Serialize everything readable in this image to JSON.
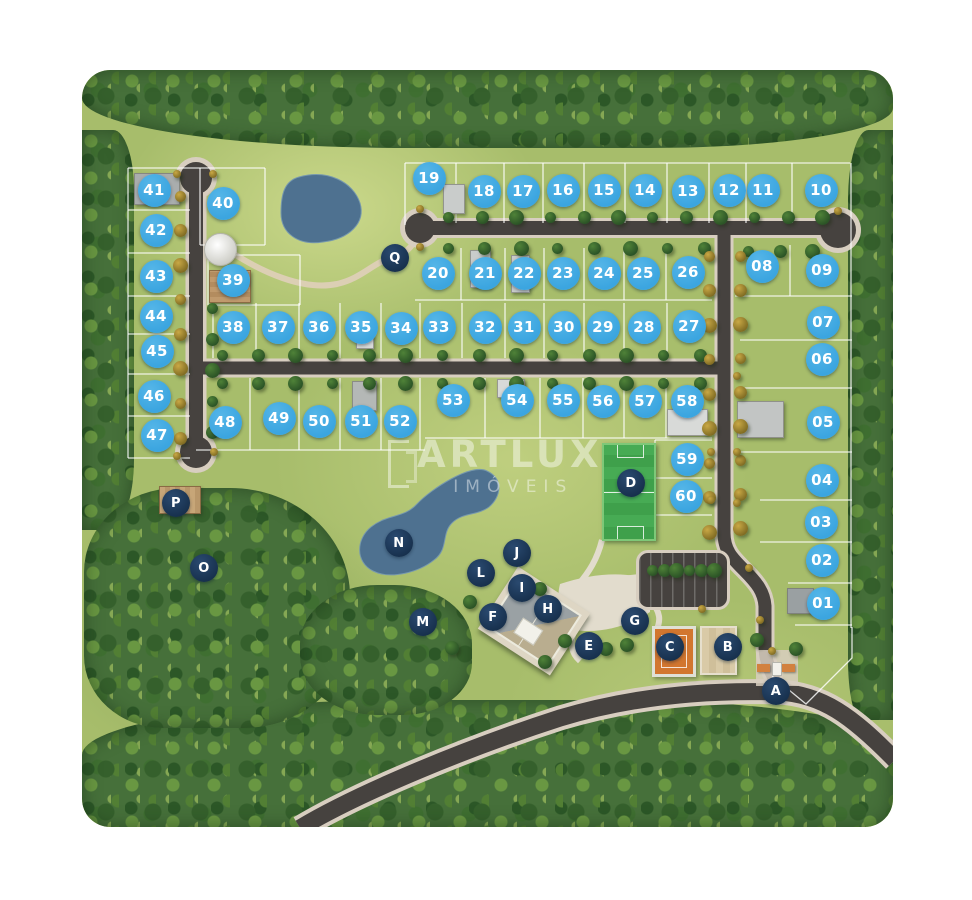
{
  "map": {
    "watermark": {
      "title": "ARTLUX",
      "subtitle": "IMÓVEIS"
    },
    "colors": {
      "lot_marker": "#3BA5E0",
      "amenity_marker": "#17304D",
      "marker_text": "#FFFFFF",
      "road": "#46423F",
      "road_edge": "#D8CEC0",
      "grass": "#A7BD6B",
      "forest": "#46703A",
      "lake": "#4E7190",
      "soccer_field": "#3FA04B",
      "tennis_court": "#D2762F",
      "sand_court": "#D9CAA7"
    },
    "lots": [
      {
        "label": "01",
        "x": 823,
        "y": 603
      },
      {
        "label": "02",
        "x": 822,
        "y": 560
      },
      {
        "label": "03",
        "x": 821,
        "y": 522
      },
      {
        "label": "04",
        "x": 822,
        "y": 480
      },
      {
        "label": "05",
        "x": 823,
        "y": 422
      },
      {
        "label": "06",
        "x": 822,
        "y": 359
      },
      {
        "label": "07",
        "x": 823,
        "y": 322
      },
      {
        "label": "08",
        "x": 762,
        "y": 266
      },
      {
        "label": "09",
        "x": 822,
        "y": 270
      },
      {
        "label": "10",
        "x": 821,
        "y": 190
      },
      {
        "label": "11",
        "x": 763,
        "y": 190
      },
      {
        "label": "12",
        "x": 729,
        "y": 190
      },
      {
        "label": "13",
        "x": 688,
        "y": 191
      },
      {
        "label": "14",
        "x": 645,
        "y": 190
      },
      {
        "label": "15",
        "x": 604,
        "y": 190
      },
      {
        "label": "16",
        "x": 563,
        "y": 190
      },
      {
        "label": "17",
        "x": 523,
        "y": 191
      },
      {
        "label": "18",
        "x": 484,
        "y": 191
      },
      {
        "label": "19",
        "x": 429,
        "y": 178
      },
      {
        "label": "20",
        "x": 438,
        "y": 273
      },
      {
        "label": "21",
        "x": 485,
        "y": 273
      },
      {
        "label": "22",
        "x": 524,
        "y": 273
      },
      {
        "label": "23",
        "x": 563,
        "y": 273
      },
      {
        "label": "24",
        "x": 604,
        "y": 273
      },
      {
        "label": "25",
        "x": 643,
        "y": 273
      },
      {
        "label": "26",
        "x": 688,
        "y": 272
      },
      {
        "label": "27",
        "x": 689,
        "y": 326
      },
      {
        "label": "28",
        "x": 644,
        "y": 327
      },
      {
        "label": "29",
        "x": 603,
        "y": 327
      },
      {
        "label": "30",
        "x": 564,
        "y": 327
      },
      {
        "label": "31",
        "x": 524,
        "y": 327
      },
      {
        "label": "32",
        "x": 485,
        "y": 327
      },
      {
        "label": "33",
        "x": 439,
        "y": 327
      },
      {
        "label": "34",
        "x": 401,
        "y": 328
      },
      {
        "label": "35",
        "x": 361,
        "y": 327
      },
      {
        "label": "36",
        "x": 319,
        "y": 327
      },
      {
        "label": "37",
        "x": 278,
        "y": 327
      },
      {
        "label": "38",
        "x": 233,
        "y": 327
      },
      {
        "label": "39",
        "x": 233,
        "y": 280
      },
      {
        "label": "40",
        "x": 223,
        "y": 203
      },
      {
        "label": "41",
        "x": 154,
        "y": 190
      },
      {
        "label": "42",
        "x": 156,
        "y": 230
      },
      {
        "label": "43",
        "x": 156,
        "y": 276
      },
      {
        "label": "44",
        "x": 156,
        "y": 316
      },
      {
        "label": "45",
        "x": 157,
        "y": 351
      },
      {
        "label": "46",
        "x": 154,
        "y": 396
      },
      {
        "label": "47",
        "x": 157,
        "y": 435
      },
      {
        "label": "48",
        "x": 225,
        "y": 422
      },
      {
        "label": "49",
        "x": 279,
        "y": 418
      },
      {
        "label": "50",
        "x": 319,
        "y": 421
      },
      {
        "label": "51",
        "x": 361,
        "y": 421
      },
      {
        "label": "52",
        "x": 400,
        "y": 421
      },
      {
        "label": "53",
        "x": 453,
        "y": 400
      },
      {
        "label": "54",
        "x": 517,
        "y": 400
      },
      {
        "label": "55",
        "x": 563,
        "y": 400
      },
      {
        "label": "56",
        "x": 603,
        "y": 401
      },
      {
        "label": "57",
        "x": 645,
        "y": 401
      },
      {
        "label": "58",
        "x": 687,
        "y": 401
      },
      {
        "label": "59",
        "x": 687,
        "y": 459
      },
      {
        "label": "60",
        "x": 686,
        "y": 496
      }
    ],
    "amenities": [
      {
        "label": "A",
        "x": 776,
        "y": 691
      },
      {
        "label": "B",
        "x": 728,
        "y": 647
      },
      {
        "label": "C",
        "x": 670,
        "y": 647
      },
      {
        "label": "D",
        "x": 631,
        "y": 483
      },
      {
        "label": "E",
        "x": 589,
        "y": 646
      },
      {
        "label": "F",
        "x": 493,
        "y": 617
      },
      {
        "label": "G",
        "x": 635,
        "y": 621
      },
      {
        "label": "H",
        "x": 548,
        "y": 609
      },
      {
        "label": "I",
        "x": 522,
        "y": 588
      },
      {
        "label": "J",
        "x": 517,
        "y": 553
      },
      {
        "label": "L",
        "x": 481,
        "y": 573
      },
      {
        "label": "M",
        "x": 423,
        "y": 622
      },
      {
        "label": "N",
        "x": 399,
        "y": 543
      },
      {
        "label": "O",
        "x": 204,
        "y": 568
      },
      {
        "label": "P",
        "x": 176,
        "y": 503
      },
      {
        "label": "Q",
        "x": 395,
        "y": 258
      }
    ]
  }
}
